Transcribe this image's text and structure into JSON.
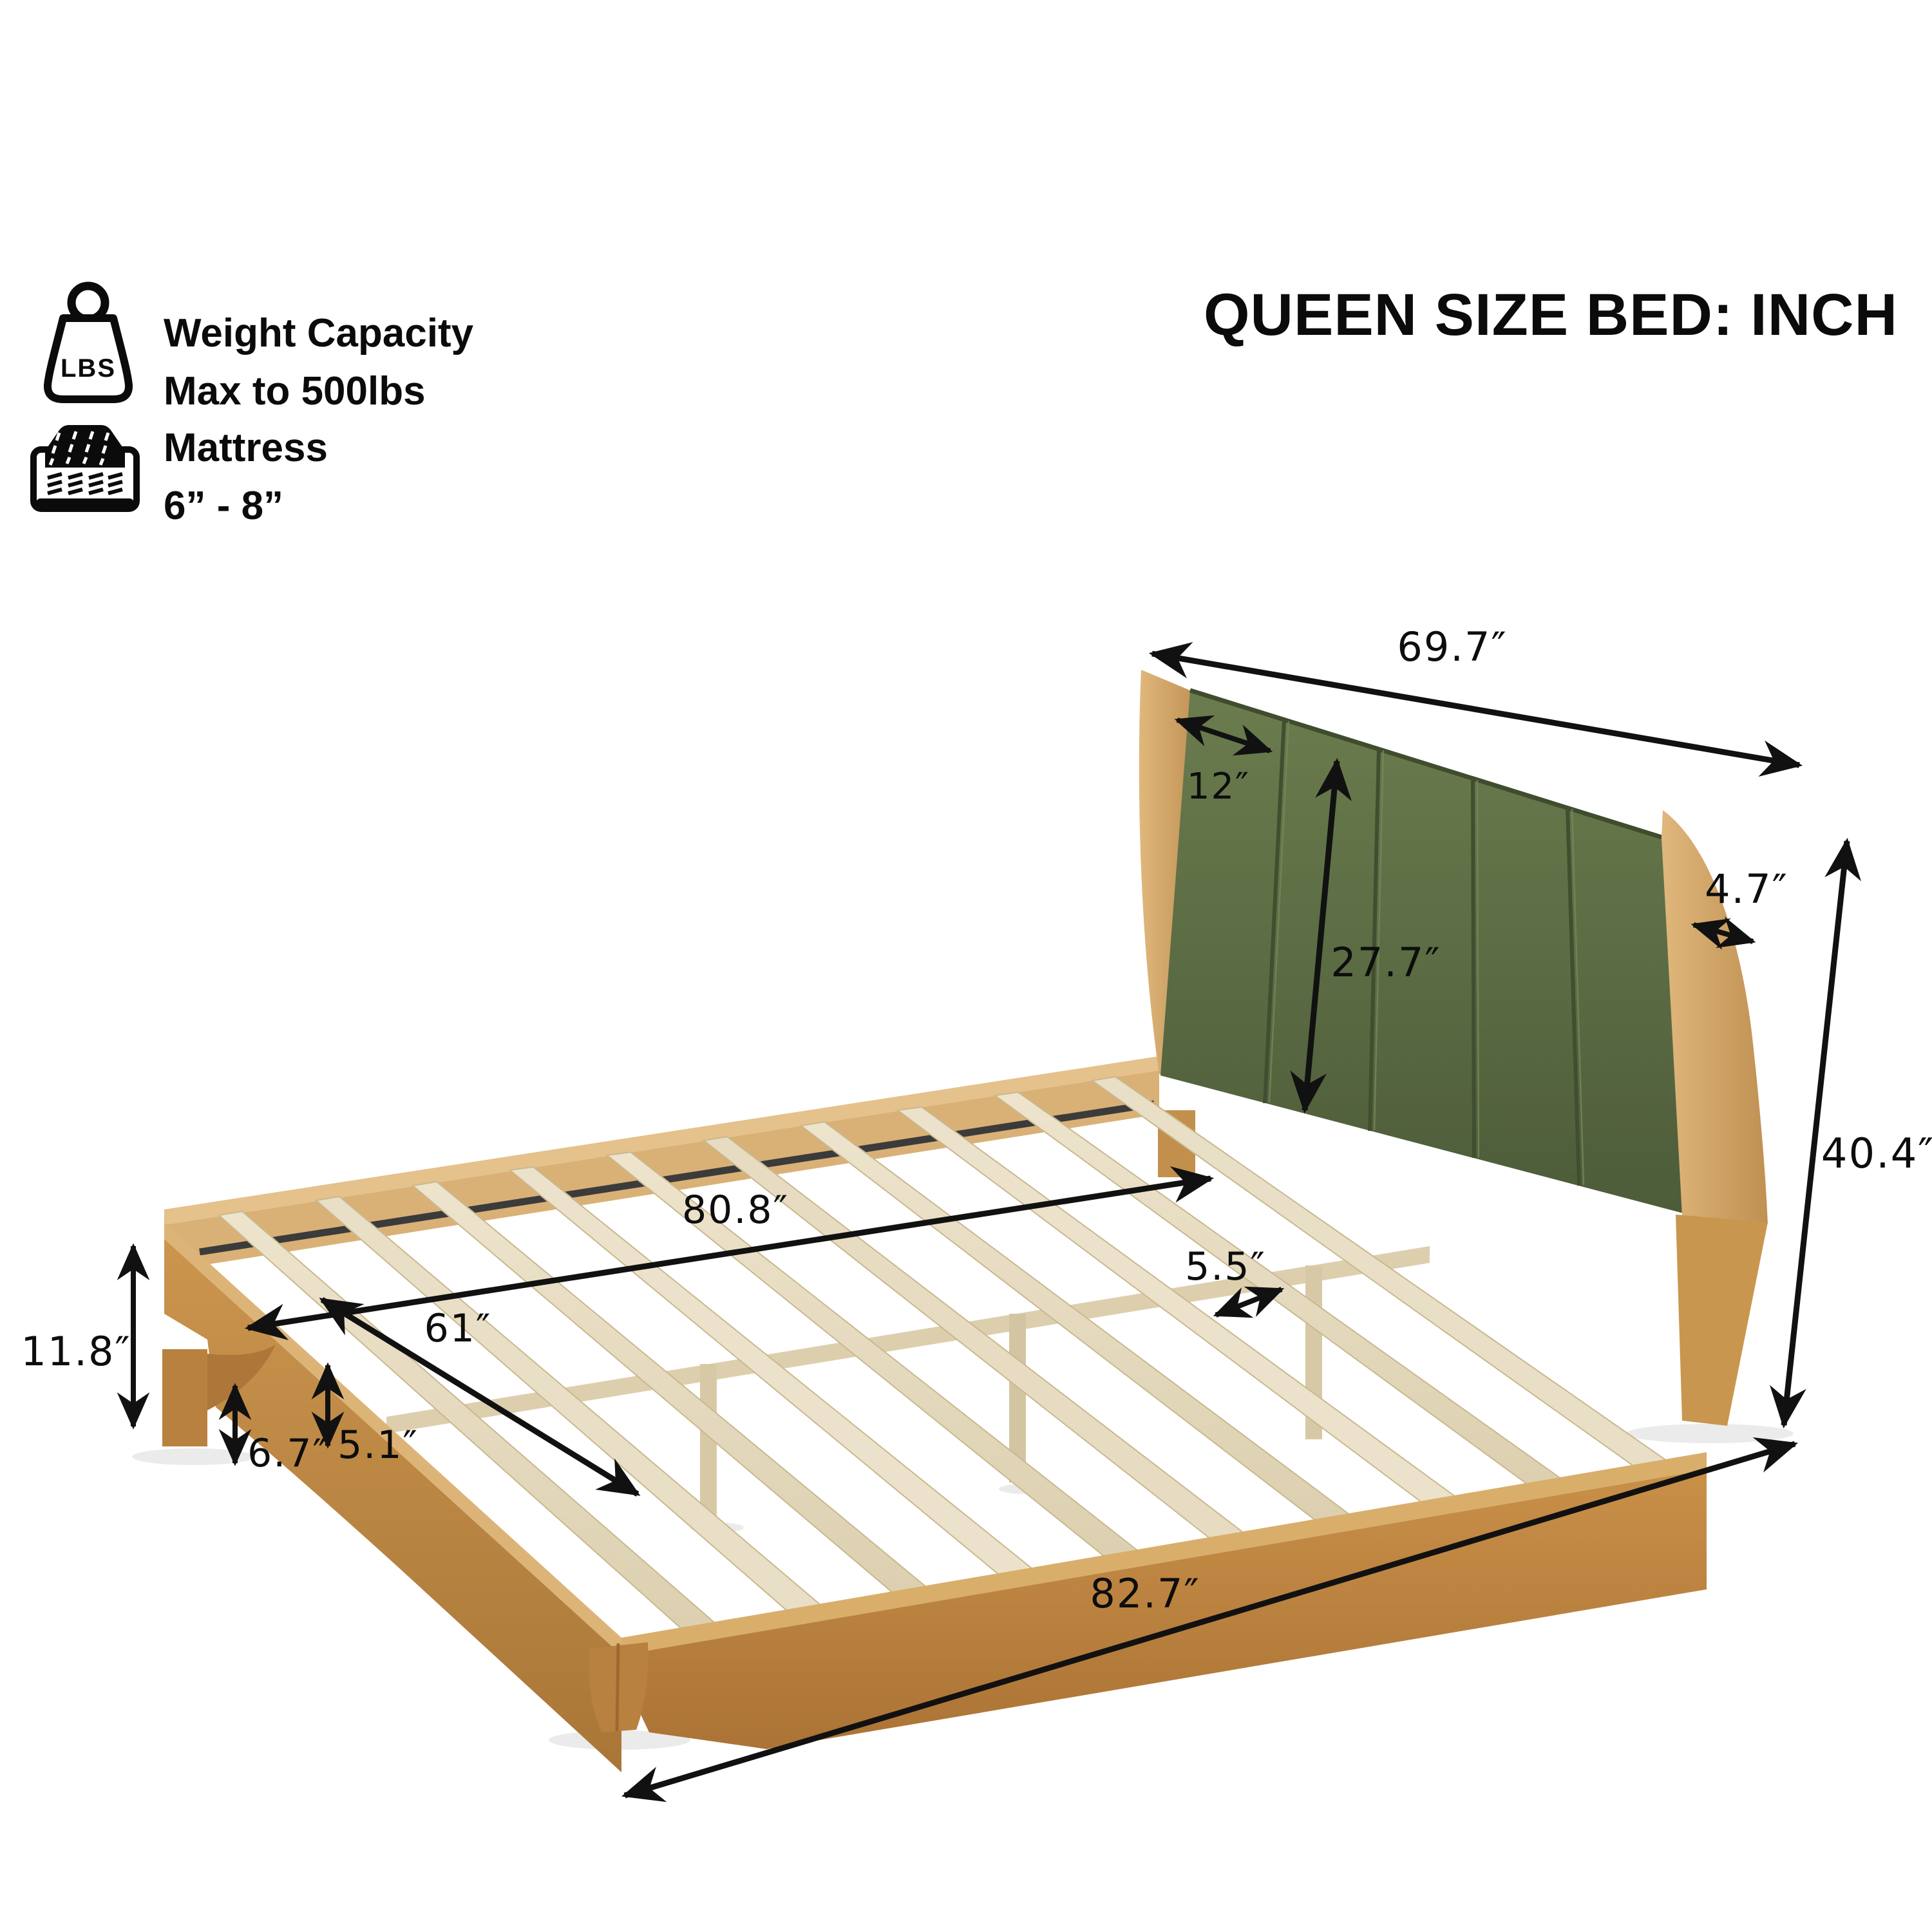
{
  "title": "QUEEN SIZE BED: INCH",
  "badges": {
    "weight": {
      "icon_label": "LBS",
      "line1": "Weight Capacity",
      "line2": "Max to 500lbs"
    },
    "mattress": {
      "line1": "Mattress",
      "line2": "6” - 8”"
    }
  },
  "dimensions": {
    "headboard_width": "69.7″",
    "channel_width": "12″",
    "panel_height": "27.7″",
    "post_depth": "4.7″",
    "headboard_height": "40.4″",
    "interior_length": "80.8″",
    "interior_width": "61″",
    "slat_gap": "5.5″",
    "frame_side_height": "11.8″",
    "floor_clearance": "6.7″",
    "rail_face_height": "5.1″",
    "overall_length": "82.7″"
  },
  "colors": {
    "background": "#ffffff",
    "annotation": "#111111",
    "frame_wood": "#c08a45",
    "headboard_wood": "#d2a76f",
    "slat_wood": "#e8ddc4",
    "fabric_green": "#5c6b44"
  }
}
